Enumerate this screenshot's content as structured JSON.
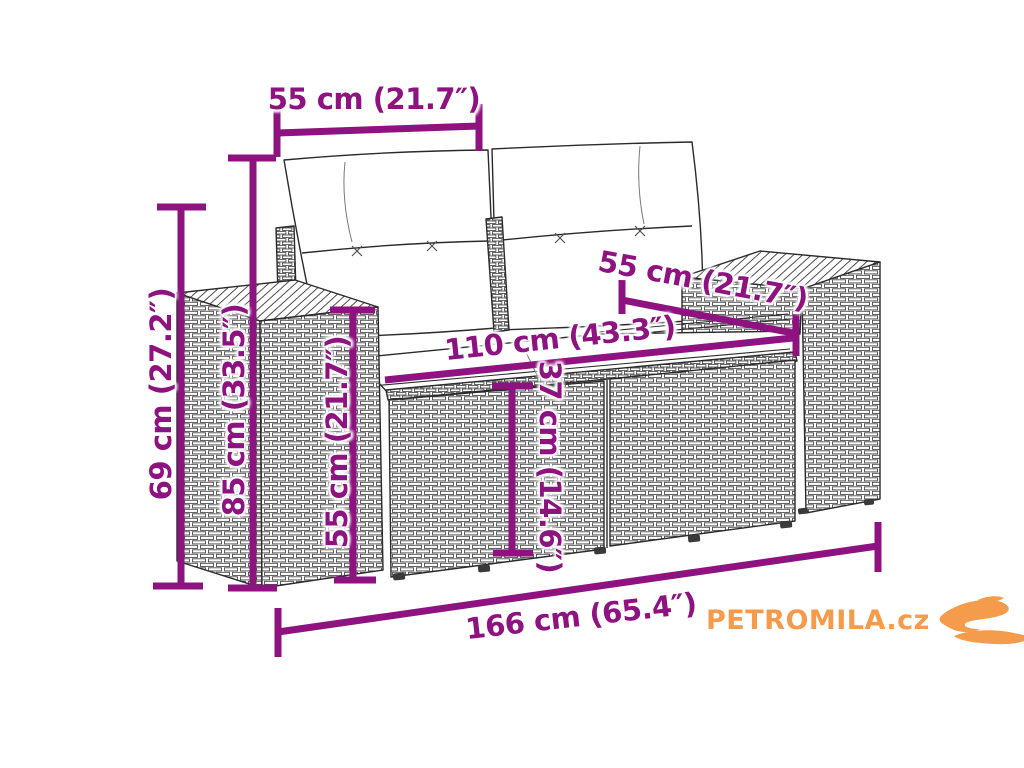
{
  "diagram": {
    "type": "product-dimension-line-drawing",
    "subject": "poly-rattan two-seater garden sofa with back and seat cushions",
    "colors": {
      "dimension_accent": "#8E1280",
      "line_art": "#2b2b2b",
      "background": "#ffffff",
      "logo_orange": "#F59B4C"
    },
    "dimensions": {
      "cushion_width": {
        "label": "55 cm (21.7″)",
        "placement": "top-horizontal"
      },
      "armrest_height": {
        "label": "69 cm (27.2″)",
        "placement": "left-outer-vertical"
      },
      "total_height": {
        "label": "85 cm (33.5″)",
        "placement": "left-inner-vertical"
      },
      "backrest_height": {
        "label": "55 cm (21.7″)",
        "placement": "inner-vertical"
      },
      "seat_width": {
        "label": "110 cm (43.3″)",
        "placement": "seat-diagonal"
      },
      "seat_depth": {
        "label": "55 cm (21.7″)",
        "placement": "seat-depth-diagonal"
      },
      "seat_height": {
        "label": "37 cm (14.6″)",
        "placement": "front-vertical"
      },
      "total_width": {
        "label": "166 cm (65.4″)",
        "placement": "bottom-diagonal"
      }
    }
  },
  "logo": {
    "text": "PETROMILA.cz",
    "icon": "swoosh-icon",
    "color": "#F59B4C"
  }
}
